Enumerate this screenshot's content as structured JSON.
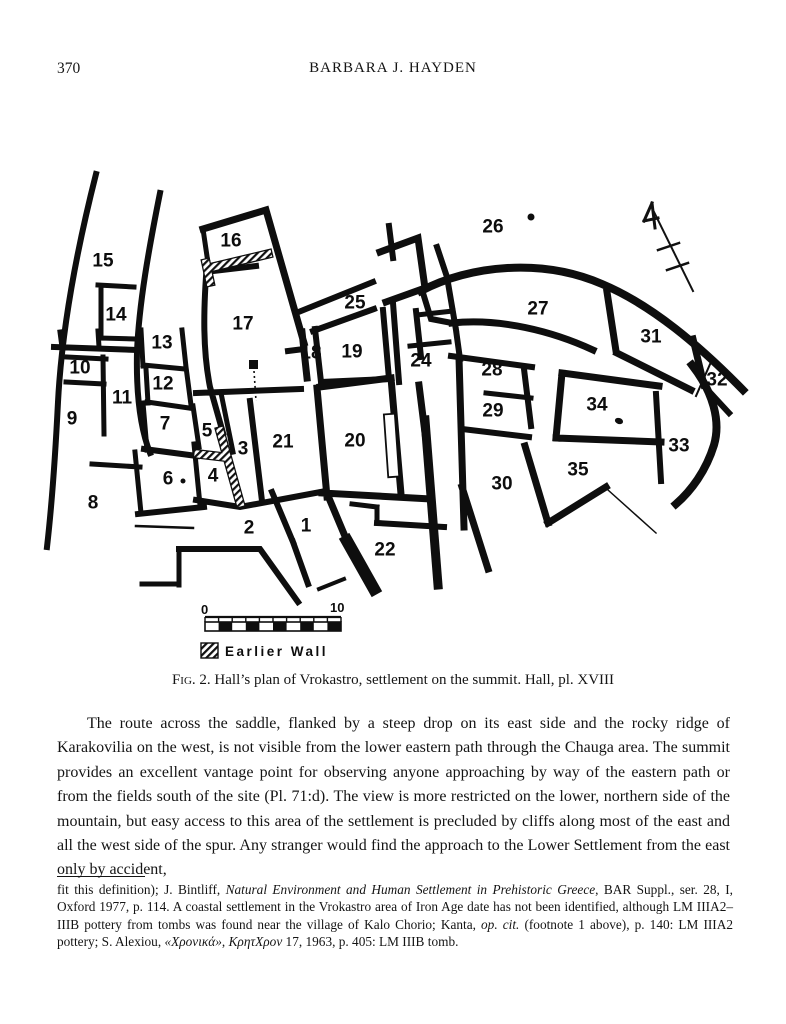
{
  "page": {
    "number": "370",
    "running_head": "BARBARA J. HAYDEN"
  },
  "figure": {
    "caption_label": "Fig. 2.",
    "caption_text": " Hall’s plan of Vrokastro, settlement on the summit. Hall, pl. XVIII",
    "scale": {
      "start_label": "0",
      "end_label": "10"
    },
    "legend": {
      "earlier_wall_label": "Earlier Wall"
    },
    "room_numbers": [
      {
        "n": "1",
        "x": 306,
        "y": 526
      },
      {
        "n": "2",
        "x": 249,
        "y": 528
      },
      {
        "n": "3",
        "x": 243,
        "y": 449
      },
      {
        "n": "4",
        "x": 213,
        "y": 476
      },
      {
        "n": "5",
        "x": 207,
        "y": 431
      },
      {
        "n": "6",
        "x": 168,
        "y": 479
      },
      {
        "n": "7",
        "x": 165,
        "y": 424
      },
      {
        "n": "8",
        "x": 93,
        "y": 503
      },
      {
        "n": "9",
        "x": 72,
        "y": 419
      },
      {
        "n": "10",
        "x": 80,
        "y": 368
      },
      {
        "n": "11",
        "x": 122,
        "y": 398
      },
      {
        "n": "12",
        "x": 163,
        "y": 384
      },
      {
        "n": "13",
        "x": 162,
        "y": 343
      },
      {
        "n": "14",
        "x": 116,
        "y": 315
      },
      {
        "n": "15",
        "x": 103,
        "y": 261
      },
      {
        "n": "16",
        "x": 231,
        "y": 241
      },
      {
        "n": "17",
        "x": 243,
        "y": 324
      },
      {
        "n": "18",
        "x": 311,
        "y": 353
      },
      {
        "n": "19",
        "x": 352,
        "y": 352
      },
      {
        "n": "20",
        "x": 355,
        "y": 441
      },
      {
        "n": "21",
        "x": 283,
        "y": 442
      },
      {
        "n": "22",
        "x": 385,
        "y": 550
      },
      {
        "n": "24",
        "x": 421,
        "y": 361
      },
      {
        "n": "25",
        "x": 355,
        "y": 303
      },
      {
        "n": "26",
        "x": 493,
        "y": 227
      },
      {
        "n": "27",
        "x": 538,
        "y": 309
      },
      {
        "n": "28",
        "x": 492,
        "y": 370
      },
      {
        "n": "29",
        "x": 493,
        "y": 411
      },
      {
        "n": "30",
        "x": 502,
        "y": 484
      },
      {
        "n": "31",
        "x": 651,
        "y": 337
      },
      {
        "n": "32",
        "x": 717,
        "y": 380
      },
      {
        "n": "33",
        "x": 679,
        "y": 446
      },
      {
        "n": "34",
        "x": 597,
        "y": 405
      },
      {
        "n": "35",
        "x": 578,
        "y": 470
      }
    ]
  },
  "body": {
    "paragraph": "The route across the saddle, flanked by a steep drop on its east side and the rocky ridge of Karakovilia on the west, is not visible from the lower eastern path through the Chauga area. The summit provides an excellent vantage point for observing anyone approaching by way of the eastern path or from the fields south of the site (Pl. 71:d). The view is more restricted on the lower, northern side of the mountain, but easy access to this area of the settlement is precluded by cliffs along most of the east and all the west side of the spur. Any stranger would find the approach to the Lower Settlement from the east only by accident,"
  },
  "footnote": {
    "segments": [
      {
        "style": "normal",
        "text": "fit this definition); J. Bintliff, "
      },
      {
        "style": "italic",
        "text": "Natural Environment and Human Settlement in Prehistoric Greece"
      },
      {
        "style": "normal",
        "text": ", BAR Suppl., ser. 28, I, Oxford 1977, p. 114. A coastal settlement in the Vrokastro area of Iron Age date has not been identified, although LM IIIA2–IIIB pottery from tombs was found near the village of Kalo Chorio; Kanta, "
      },
      {
        "style": "italic",
        "text": "op. cit."
      },
      {
        "style": "normal",
        "text": " (footnote 1 above), p. 140: LM IIIA2 pottery; S. Alexiou, "
      },
      {
        "style": "italic",
        "text": "«Χρονικά»"
      },
      {
        "style": "normal",
        "text": ", "
      },
      {
        "style": "italic",
        "text": "ΚρητΧρον"
      },
      {
        "style": "normal",
        "text": " 17, 1963, p. 405: LM IIIB tomb."
      }
    ]
  }
}
